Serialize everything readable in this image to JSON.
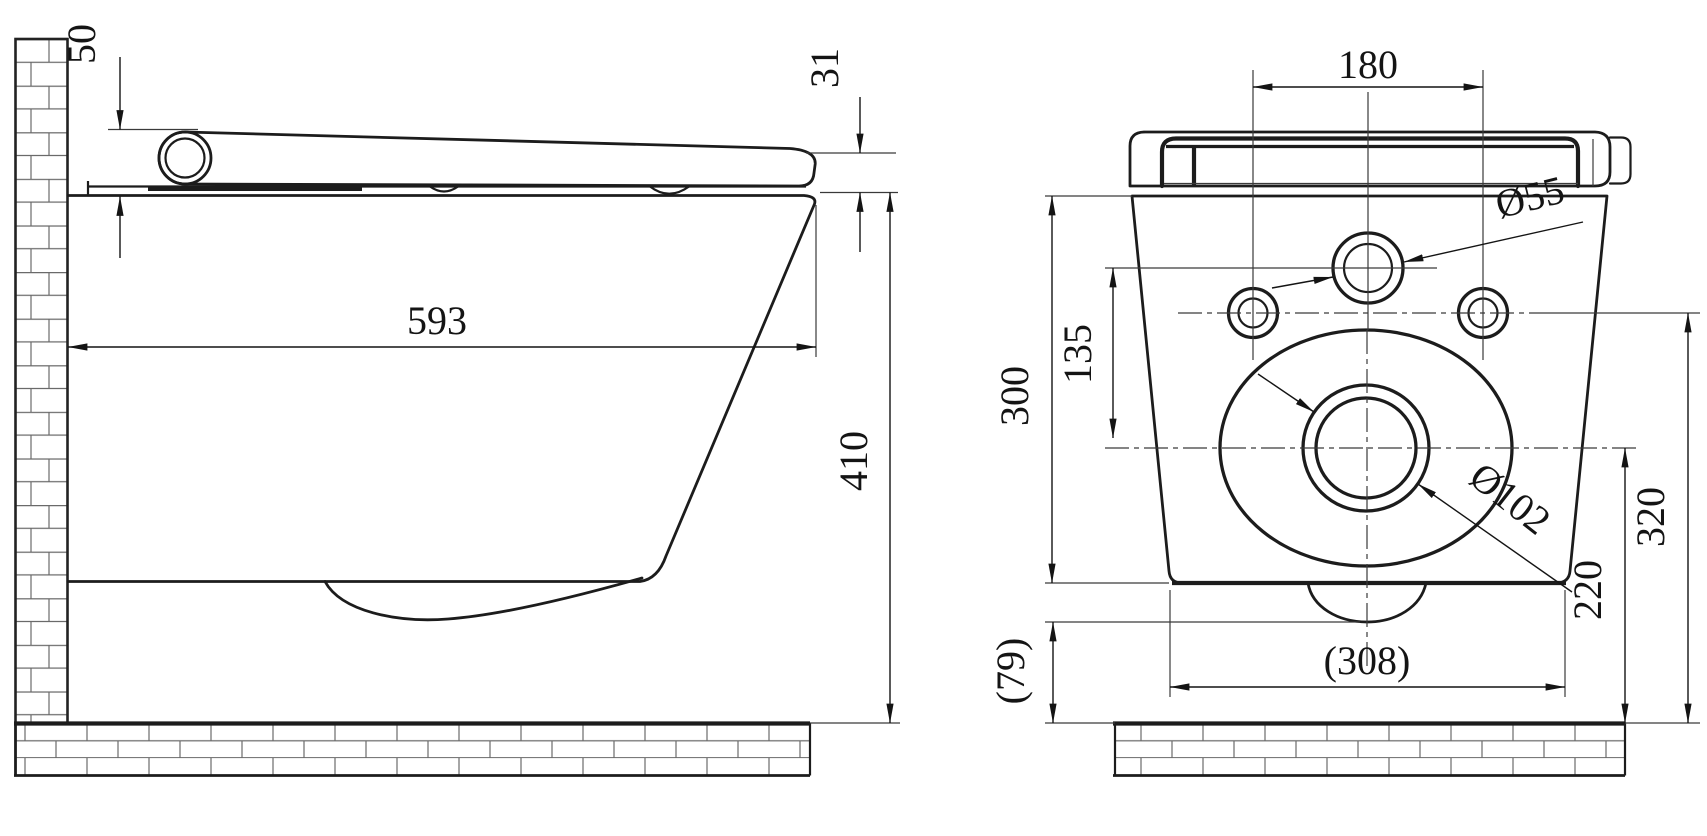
{
  "side_view": {
    "dim_lid_height_rear": "50",
    "dim_lid_height_front": "31",
    "dim_depth": "593",
    "dim_height": "410"
  },
  "rear_view": {
    "dim_hole_spacing": "180",
    "dim_supply_hole_diameter": "Ø55",
    "dim_supply_to_drain": "135",
    "dim_body_height": "300",
    "dim_drain_center_height": "220",
    "dim_holes_center_height": "320",
    "dim_drain_floor_clearance": "(79)",
    "dim_base_width": "(308)",
    "dim_drain_diameter": "Ø102"
  }
}
